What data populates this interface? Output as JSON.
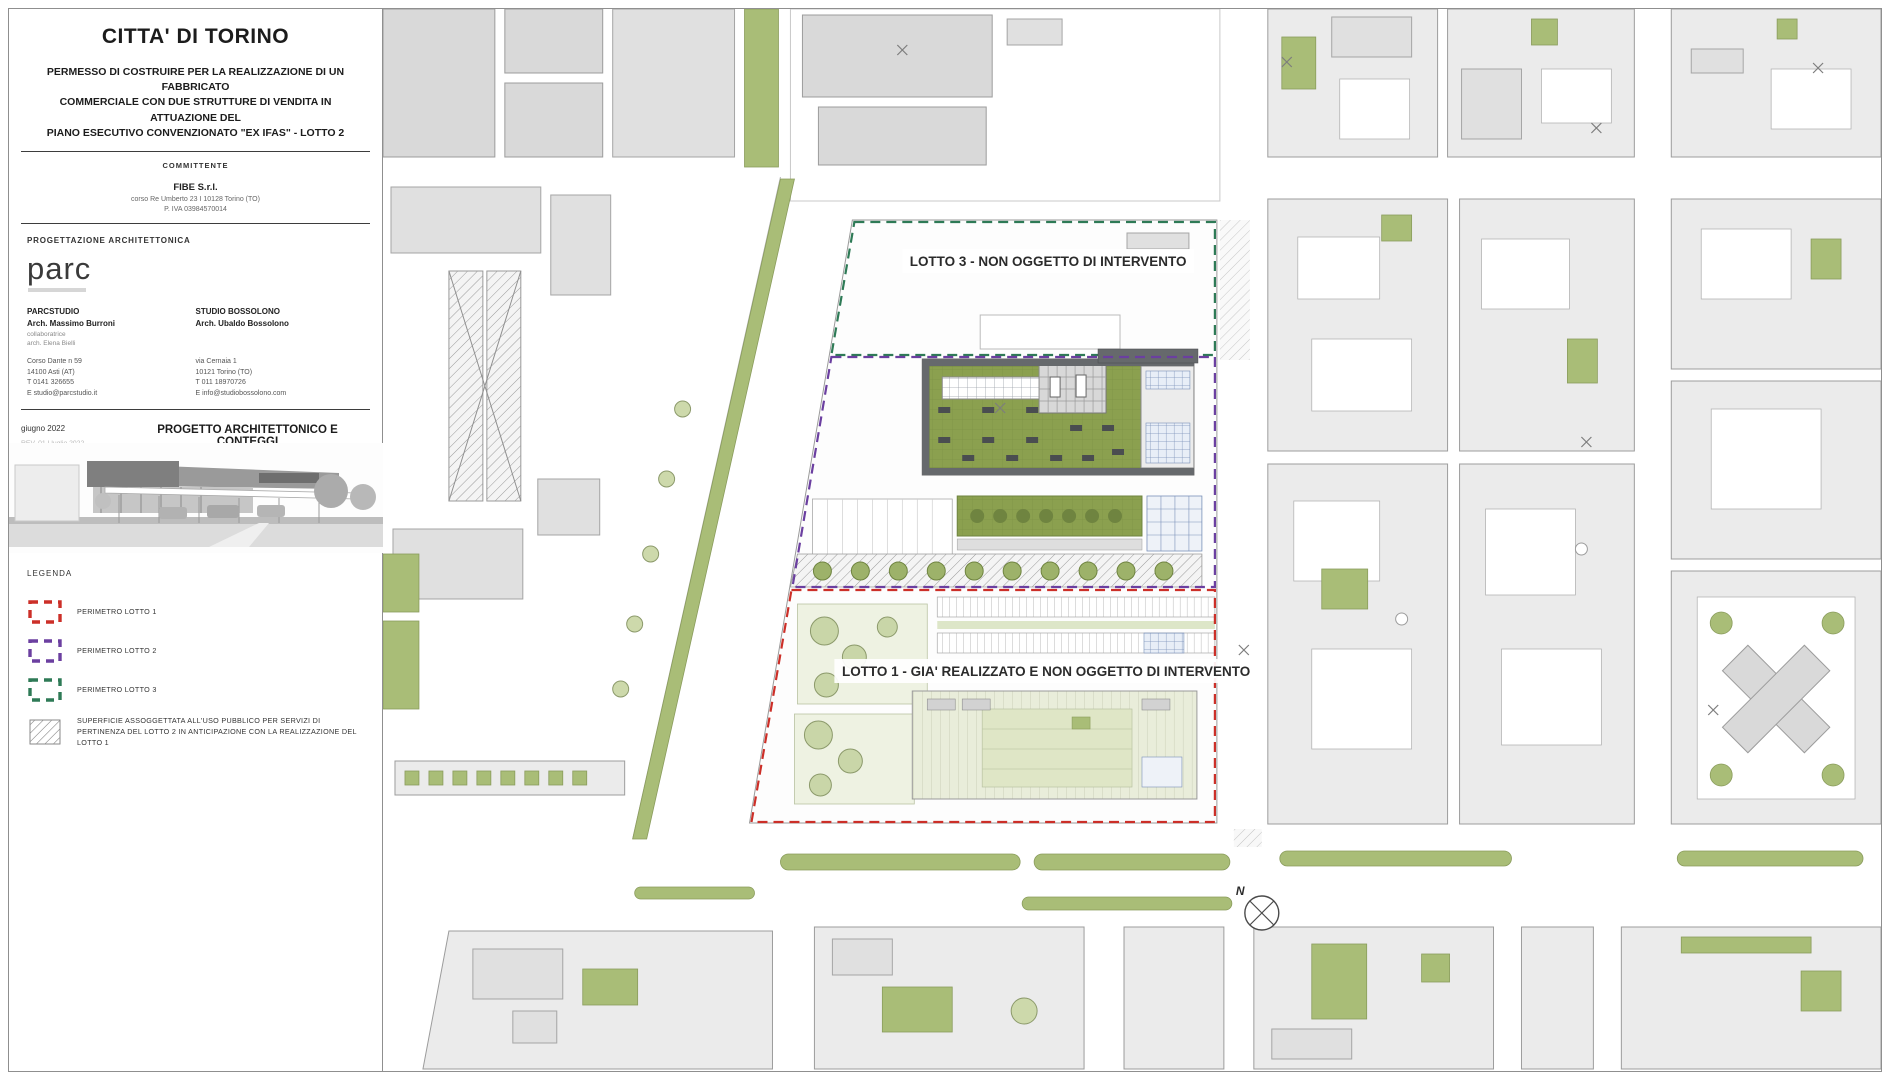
{
  "title_block": {
    "city": "CITTA' DI TORINO",
    "permit_lines": [
      "PERMESSO DI COSTRUIRE PER LA REALIZZAZIONE DI UN FABBRICATO",
      "COMMERCIALE CON DUE STRUTTURE DI VENDITA IN ATTUAZIONE DEL",
      "PIANO ESECUTIVO CONVENZIONATO \"EX IFAS\" - LOTTO 2"
    ],
    "committente": {
      "label": "COMMITTENTE",
      "name": "FIBE S.r.l.",
      "address": "corso Re Umberto 23 I 10128 Torino (TO)",
      "piva": "P. IVA 03984570014"
    },
    "progettazione": {
      "label": "PROGETTAZIONE ARCHITETTONICA",
      "logo": "parc",
      "studio1": {
        "name": "PARCSTUDIO",
        "architect": "Arch. Massimo Burroni",
        "collab_label": "collaboratrice",
        "collab": "arch. Elena Bielli",
        "address1": "Corso Dante n 59",
        "address2": "14100 Asti (AT)",
        "phone": "T 0141 326655",
        "email": "E studio@parcstudio.it"
      },
      "studio2": {
        "name": "STUDIO BOSSOLONO",
        "architect": "Arch. Ubaldo Bossolono",
        "address1": "via Cernaia 1",
        "address2": "10121 Torino (TO)",
        "phone": "T 011 18970726",
        "email": "E info@studiobossolono.com"
      }
    },
    "issue": {
      "date": "giugno 2022",
      "rev_old": "REV. 01 I luglio 2022",
      "rev_new": "REV. 03 I settembre 2022",
      "project_title": "PROGETTO ARCHITETTONICO E CONTEGGI",
      "drawing_title": "Planimetria generale",
      "stamp": "TAVOLA SOSTITUTIVA",
      "sheet_number": "3.A",
      "scale": "scala 1:500"
    },
    "legend": {
      "title": "LEGENDA",
      "items": [
        {
          "label": "PERIMETRO LOTTO 1",
          "color": "#cc2f28"
        },
        {
          "label": "PERIMETRO LOTTO 2",
          "color": "#6b3fa0"
        },
        {
          "label": "PERIMETRO LOTTO 3",
          "color": "#2e7a56"
        },
        {
          "label": "SUPERFICIE ASSOGGETTATA ALL'USO PUBBLICO PER SERVIZI DI PERTINENZA DEL LOTTO 2 IN ANTICIPAZIONE CON LA REALIZZAZIONE DEL LOTTO 1",
          "color": "#777777"
        }
      ]
    }
  },
  "map": {
    "labels": {
      "lotto3": "LOTTO 3 - NON OGGETTO DI INTERVENTO",
      "lotto1": "LOTTO 1 - GIA' REALIZZATO E NON OGGETTO DI INTERVENTO"
    },
    "north": "N",
    "colors": {
      "block_gray": "#ebebeb",
      "building_gray": "#d9d9d9",
      "green": "#a9bd77",
      "roof_green": "#8ba04f",
      "pale_green": "#e6ecd4",
      "lotto1_red": "#cc2f28",
      "lotto2_purple": "#6b3fa0",
      "lotto3_green": "#2e7a56",
      "dark_band": "#66696c"
    }
  }
}
